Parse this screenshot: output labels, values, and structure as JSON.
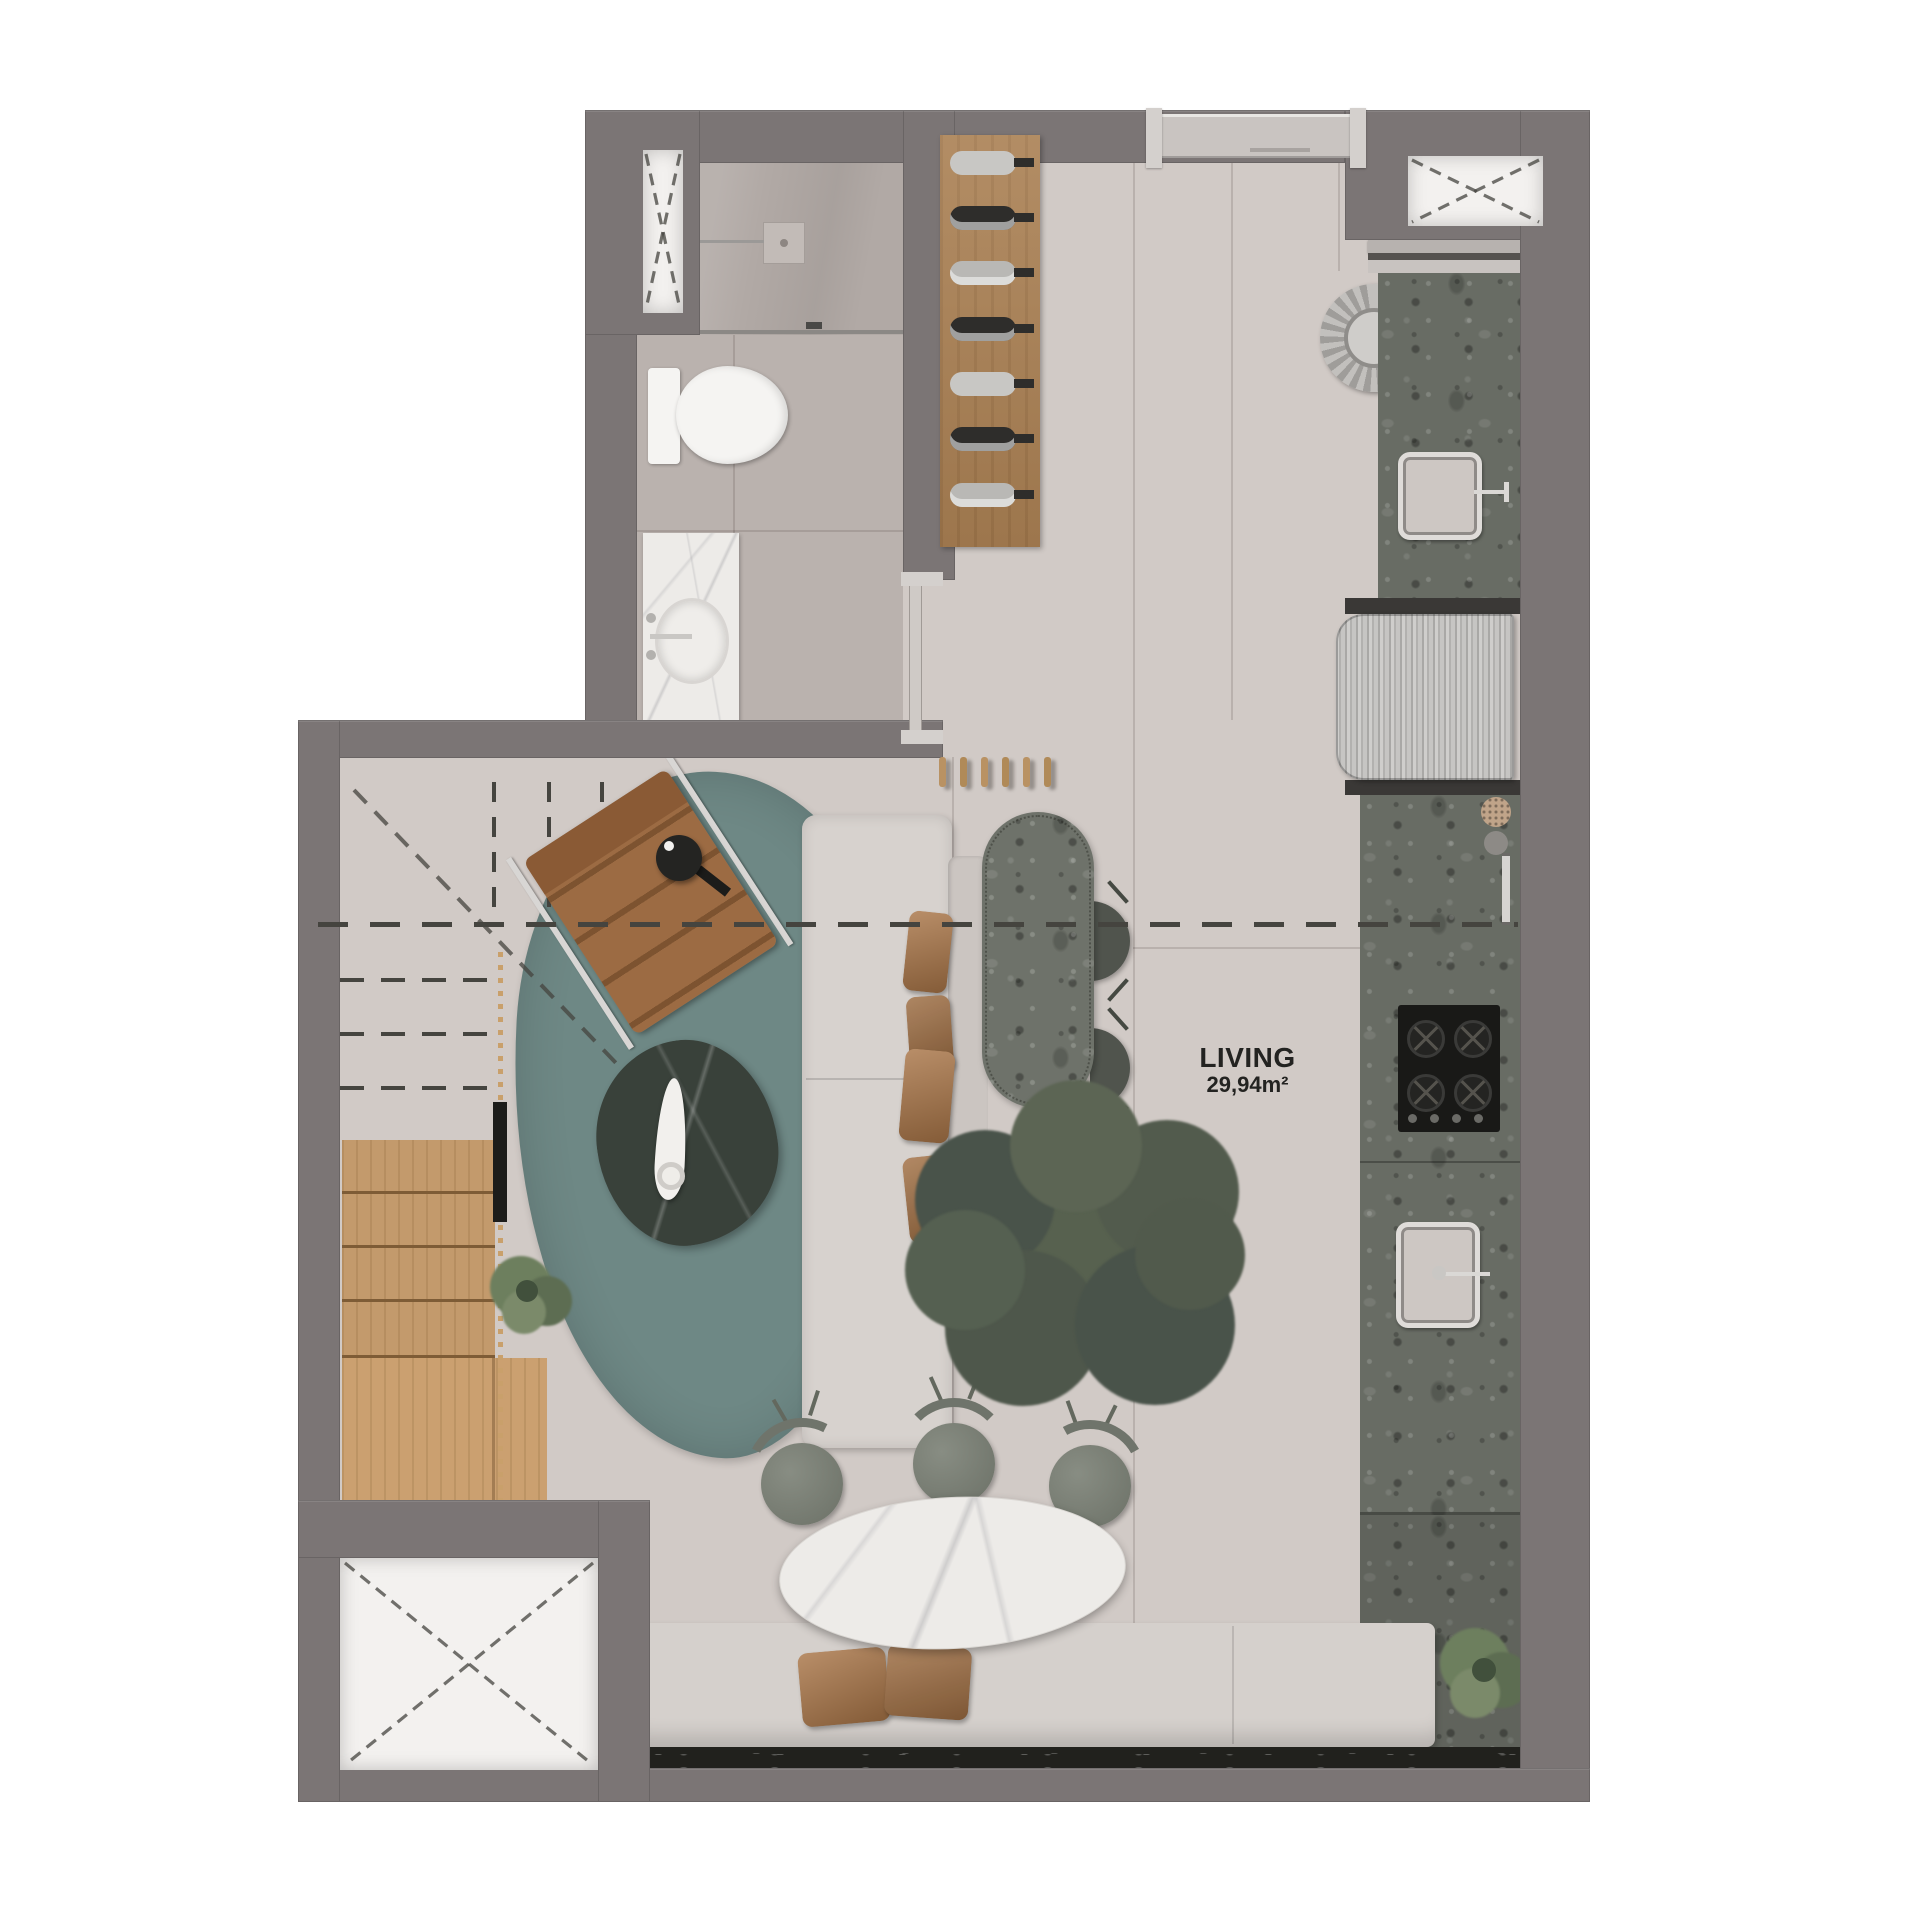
{
  "title": "Studio apartment floor plan render",
  "label": {
    "room": "LIVING",
    "area": "29,94m²"
  },
  "palette": {
    "bg": "#ffffff",
    "wall": "#7b7575",
    "wallEdge": "#6a6464",
    "floor": "#d1cac6",
    "floorBath": "#bab2ae",
    "floorShower": "#b1a9a5",
    "shaft": "#f3f1ef",
    "doorPanel": "#c9c4c1",
    "wood": "#aa8053",
    "stairWood": "#c39a6c",
    "rug": "#6e8885",
    "sofa": "#d7d2ce",
    "sofaBack": "#cbc5c1",
    "pillowBrown": "#a97547",
    "bench": "#d5d0cc",
    "marble": "#edebe8",
    "marbleDark": "#21211d",
    "chairGray": "#7d8279",
    "stoolGreen": "#50544d",
    "granite": "#686c64",
    "cooktopBlack": "#191917",
    "steel": "#c2c1bf",
    "tree": "#57614f",
    "treeDark": "#49534a",
    "plantGreen": "#6d7f5e",
    "dashColor": "#45443f",
    "textColor": "#232321",
    "white": "#f5f4f2"
  },
  "rooms": [
    {
      "id": "living",
      "label": "LIVING",
      "area": "29,94m²"
    },
    {
      "id": "bathroom",
      "label": ""
    },
    {
      "id": "kitchen",
      "label": ""
    },
    {
      "id": "entry",
      "label": ""
    },
    {
      "id": "stair-void",
      "label": ""
    }
  ],
  "fixtures": [
    "entry-door",
    "shaft-x-top-right",
    "shaft-x-bottom-left",
    "shower-niche",
    "shower-head",
    "shower-drain",
    "glass-partition",
    "toilet",
    "vanity-sink",
    "sliding-door",
    "wine-rack",
    "laundry-tub",
    "kitchen-sink-top",
    "refrigerator",
    "spice-jars",
    "cabinet-handle",
    "cooktop",
    "kitchen-sink-bottom",
    "staircase",
    "stair-railing",
    "rug",
    "lounge-chair",
    "side-table",
    "sofa",
    "sofa-pillows",
    "coffee-table",
    "kitchen-island",
    "bar-stools",
    "coat-pegs",
    "indoor-tree",
    "dining-table",
    "dining-chairs",
    "bench-seat",
    "bench-pillows",
    "plant-stairs",
    "plant-bench",
    "upper-floor-projection-dashes"
  ]
}
